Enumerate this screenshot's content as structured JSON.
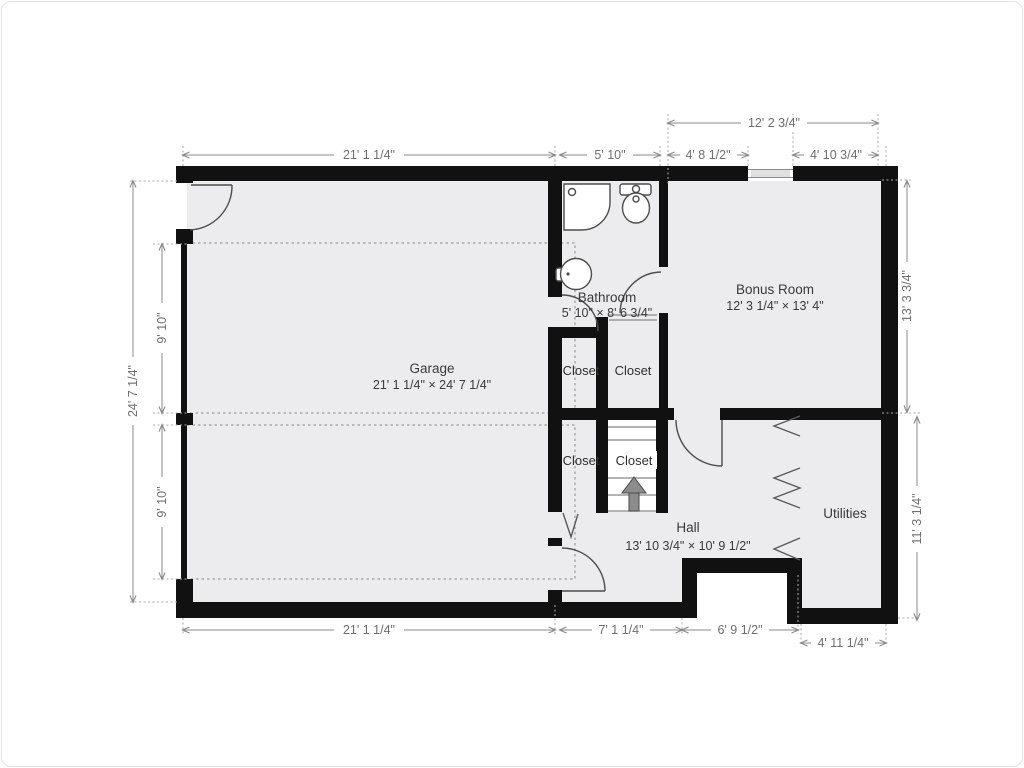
{
  "plan": {
    "rooms": {
      "garage": {
        "name": "Garage",
        "dims": "21' 1 1/4\" × 24' 7 1/4\""
      },
      "bathroom": {
        "name": "Bathroom",
        "dims": "5' 10\" × 8' 6 3/4\""
      },
      "bonus_room": {
        "name": "Bonus Room",
        "dims": "12' 3 1/4\" × 13' 4\""
      },
      "hall": {
        "name": "Hall",
        "dims": "13' 10 3/4\" × 10' 9 1/2\""
      },
      "utilities": {
        "name": "Utilities"
      },
      "closet_upper_left": {
        "name": "Closet"
      },
      "closet_upper_right": {
        "name": "Closet"
      },
      "closet_lower_left": {
        "name": "Closet"
      },
      "closet_stairs": {
        "name": "Closet"
      }
    },
    "dimensions": {
      "top_outer": "12' 2 3/4\"",
      "top": [
        "21' 1 1/4\"",
        "5' 10\"",
        "4' 8 1/2\"",
        "4' 10 3/4\""
      ],
      "left_outer": "24' 7 1/4\"",
      "left": [
        "9' 10\"",
        "9' 10\""
      ],
      "right": [
        "13' 3 3/4\"",
        "11' 3 1/4\""
      ],
      "bottom": [
        "21' 1 1/4\"",
        "7' 1 1/4\"",
        "6' 9 1/2\"",
        "4' 11 1/4\""
      ]
    },
    "colors": {
      "wall": "#111111",
      "floor": "#ececee",
      "dimension": "#8a8a8a"
    }
  }
}
